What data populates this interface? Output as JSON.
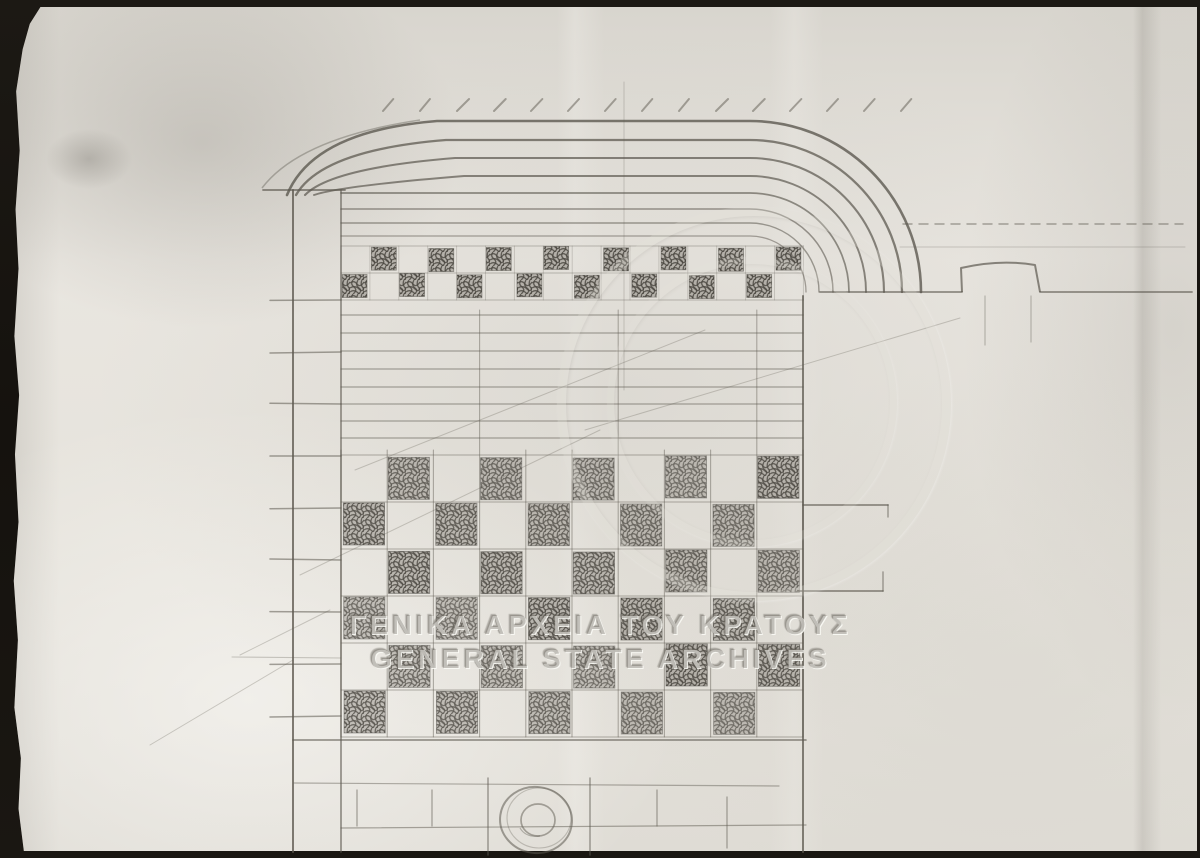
{
  "watermark": {
    "line1": "ΓΕΝΙΚΑ ΑΡΧΕΙΑ ΤΟΥ ΚΡΑΤΟΥΣ",
    "line2": "GENERAL STATE ARCHIVES"
  },
  "palette": {
    "scanner_bg": "#17140f",
    "paper": "#e6e3dd",
    "paper_shade": "#d8d5ce",
    "pencil": "#5d5950",
    "pencil_dark": "#49453f"
  },
  "drawing": {
    "viewBox": "0 0 1200 858",
    "arch": {
      "cx": 750,
      "baseY": 292,
      "tops": [
        121,
        140,
        158,
        176,
        193,
        209,
        223,
        236
      ],
      "widths": [
        2.6,
        2.3,
        2.1,
        1.9,
        1.7,
        1.5,
        1.4,
        1.3
      ],
      "ops": [
        0.8,
        0.75,
        0.72,
        0.7,
        0.66,
        0.6,
        0.56,
        0.52
      ],
      "springs": [
        287,
        296,
        305,
        314
      ]
    },
    "hatch": {
      "y1": 99,
      "y2": 111,
      "x0": 383,
      "x1": 932,
      "step": 37,
      "dx": 11
    },
    "impost": [
      263,
      190,
      345,
      190
    ],
    "hood": "M262,188 Q300,138 420,120",
    "pier": {
      "xA": 293,
      "xB": 341,
      "y0": 190,
      "y1": 852,
      "tickX0": 270,
      "ticks": [
        300,
        352,
        404,
        456,
        508,
        560,
        612,
        664,
        716
      ],
      "longTick": [
        232,
        657,
        341,
        658
      ]
    },
    "centerline": [
      624,
      82,
      624,
      390
    ],
    "topBand": {
      "x": 341,
      "y": 246,
      "cols": 16,
      "rows": 2,
      "cw": 28.9,
      "ch": 27
    },
    "courses": {
      "x0": 341,
      "x1": 803,
      "ys": [
        315,
        333,
        351,
        369,
        387,
        404,
        421,
        438
      ]
    },
    "mainGrid": {
      "x": 341,
      "y": 455,
      "cols": 10,
      "rows": 6,
      "cw": 46.2,
      "ch": 47,
      "extendCols": [
        3,
        6,
        9
      ],
      "extendY": 310
    },
    "rightEdge": [
      803,
      296,
      803,
      852
    ],
    "projection": {
      "lines": [
        [
          803,
          505,
          888,
          505
        ],
        [
          798,
          591,
          883,
          591
        ]
      ],
      "ticks": [
        [
          888,
          505,
          888,
          517
        ],
        [
          883,
          572,
          883,
          591
        ]
      ]
    },
    "ground": {
      "segs": [
        [
          820,
          292,
          962,
          292
        ],
        [
          1040,
          292,
          1192,
          292
        ]
      ],
      "dashed": [
        903,
        224,
        1183,
        224
      ],
      "faint": [
        900,
        247,
        1185,
        247
      ]
    },
    "bump": {
      "path": "M962,292 L961,268 Q1000,259 1035,265 L1040,292",
      "stubs": [
        [
          985,
          296,
          985,
          345
        ],
        [
          1031,
          296,
          1031,
          342
        ]
      ]
    },
    "bottom": {
      "lines": [
        [
          293,
          740,
          806,
          740
        ],
        [
          294,
          783,
          779,
          786
        ],
        [
          341,
          828,
          806,
          825
        ]
      ],
      "joints": [
        [
          357,
          790,
          357,
          826
        ],
        [
          432,
          790,
          432,
          826
        ],
        [
          657,
          790,
          657,
          826
        ],
        [
          727,
          797,
          727,
          848
        ]
      ],
      "circle": {
        "cx": 536,
        "cy": 820,
        "rx": 36,
        "ry": 33,
        "rxi": 17,
        "ryi": 16,
        "brackets": [
          [
            488,
            778,
            488,
            855
          ],
          [
            590,
            778,
            590,
            855
          ]
        ]
      }
    },
    "diagonals": [
      [
        300,
        575,
        600,
        430
      ],
      [
        355,
        470,
        705,
        330
      ],
      [
        585,
        430,
        960,
        318
      ],
      [
        150,
        745,
        293,
        660
      ],
      [
        240,
        655,
        330,
        610
      ]
    ]
  }
}
